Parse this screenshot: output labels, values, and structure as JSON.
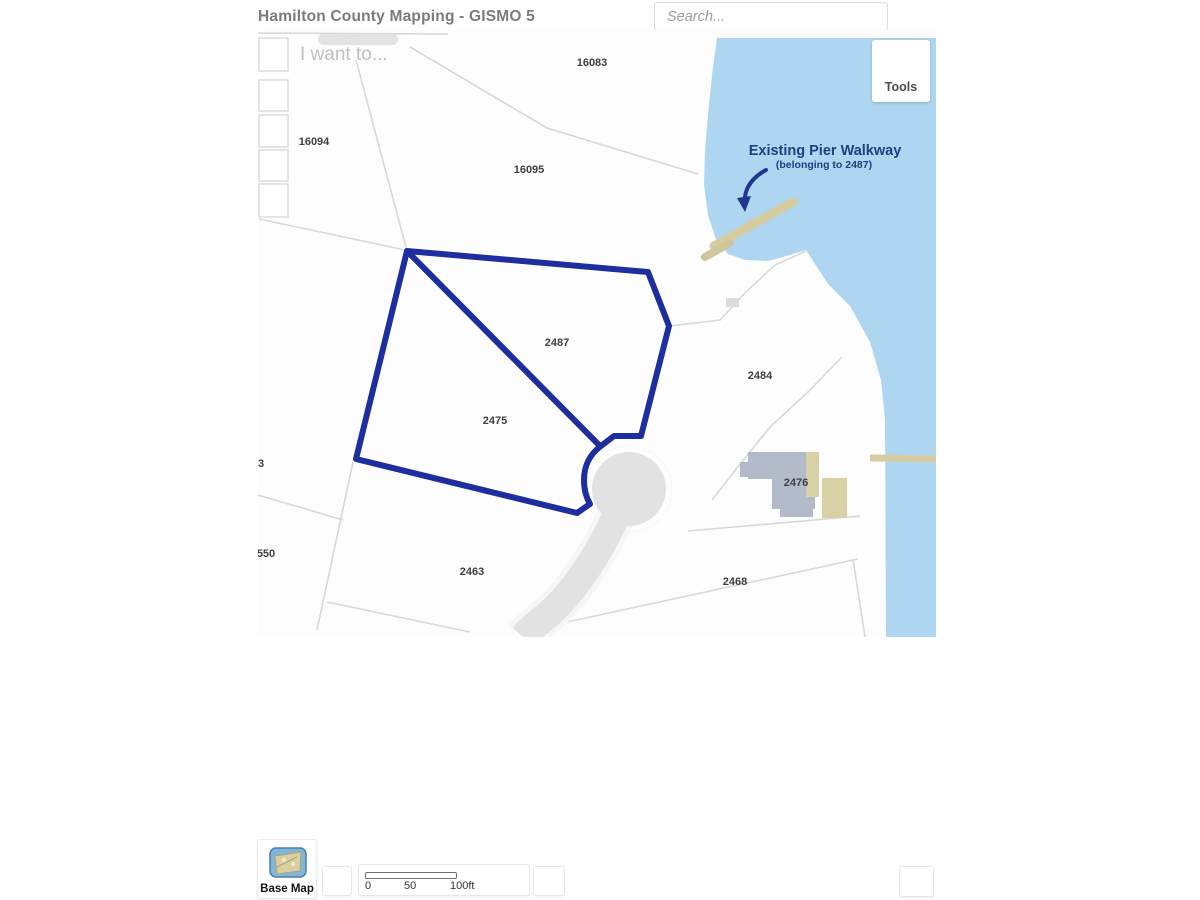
{
  "header": {
    "title": "Hamilton County Mapping - GISMO 5",
    "search_placeholder": "Search...",
    "i_want_to_label": "I want to...",
    "tools_label": "Tools"
  },
  "map": {
    "annotation": {
      "line1": "Existing Pier Walkway",
      "line2": "(belonging to 2487)"
    },
    "selected_parcels": [
      "2487",
      "2475"
    ],
    "parcel_labels": [
      {
        "text": "16083",
        "x": 592,
        "y": 66
      },
      {
        "text": "16095",
        "x": 529,
        "y": 173
      },
      {
        "text": "16094",
        "x": 314,
        "y": 145
      },
      {
        "text": "2487",
        "x": 557,
        "y": 346
      },
      {
        "text": "2475",
        "x": 495,
        "y": 424
      },
      {
        "text": "2484",
        "x": 760,
        "y": 379
      },
      {
        "text": "2476",
        "x": 796,
        "y": 486
      },
      {
        "text": "2463",
        "x": 472,
        "y": 575
      },
      {
        "text": "2468",
        "x": 735,
        "y": 585
      },
      {
        "text": "3",
        "x": 261,
        "y": 467
      },
      {
        "text": "550",
        "x": 266,
        "y": 557
      }
    ],
    "colors": {
      "water": "#aed6f0",
      "selection_outline": "#1e2e9e",
      "annotation_text": "#1c4080",
      "road": "#e2e2e2",
      "pier": "#d5cda1",
      "building": "#b3bac9",
      "building_tan": "#d8d1a6",
      "parcel_line": "#d8d8d8"
    }
  },
  "footer": {
    "base_map_label": "Base Map",
    "scale": {
      "start": "0",
      "mid": "50",
      "end": "100ft"
    }
  }
}
